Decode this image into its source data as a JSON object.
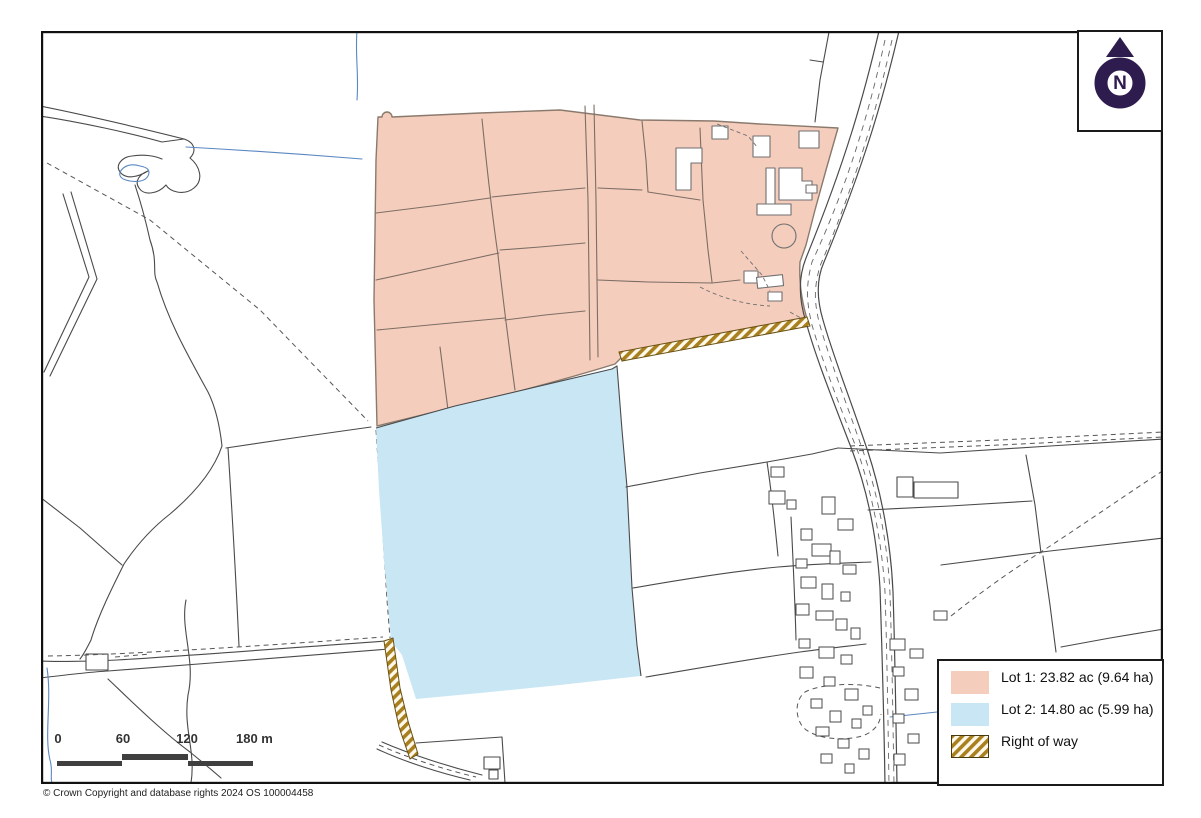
{
  "map": {
    "copyright": "© Crown Copyright and database rights 2024 OS 100004458",
    "north": {
      "label": "N",
      "color": "#2f1c4e"
    },
    "legend": {
      "items": [
        {
          "id": "lot1",
          "label": "Lot 1: 23.82 ac (9.64 ha)",
          "swatch_color": "#f5cdbd"
        },
        {
          "id": "lot2",
          "label": "Lot 2: 14.80 ac (5.99 ha)",
          "swatch_color": "#c9e6f5"
        },
        {
          "id": "right-of-way",
          "label": "Right of way",
          "swatch_color": "#a9801e",
          "swatch_style": "hatch"
        }
      ]
    },
    "scale_bar": {
      "tick_labels": [
        "0",
        "60",
        "120",
        "180 m"
      ],
      "bar_color": "#3f3f3f"
    },
    "colors": {
      "lot1_fill": "#f5cdbd",
      "lot2_fill": "#c9e6f5",
      "right_of_way_stripe": "#a9801e",
      "right_of_way_edge": "#6b5213",
      "stream": "#5a87c2",
      "boundary": "#4a4a4a",
      "frame": "#111111"
    }
  }
}
